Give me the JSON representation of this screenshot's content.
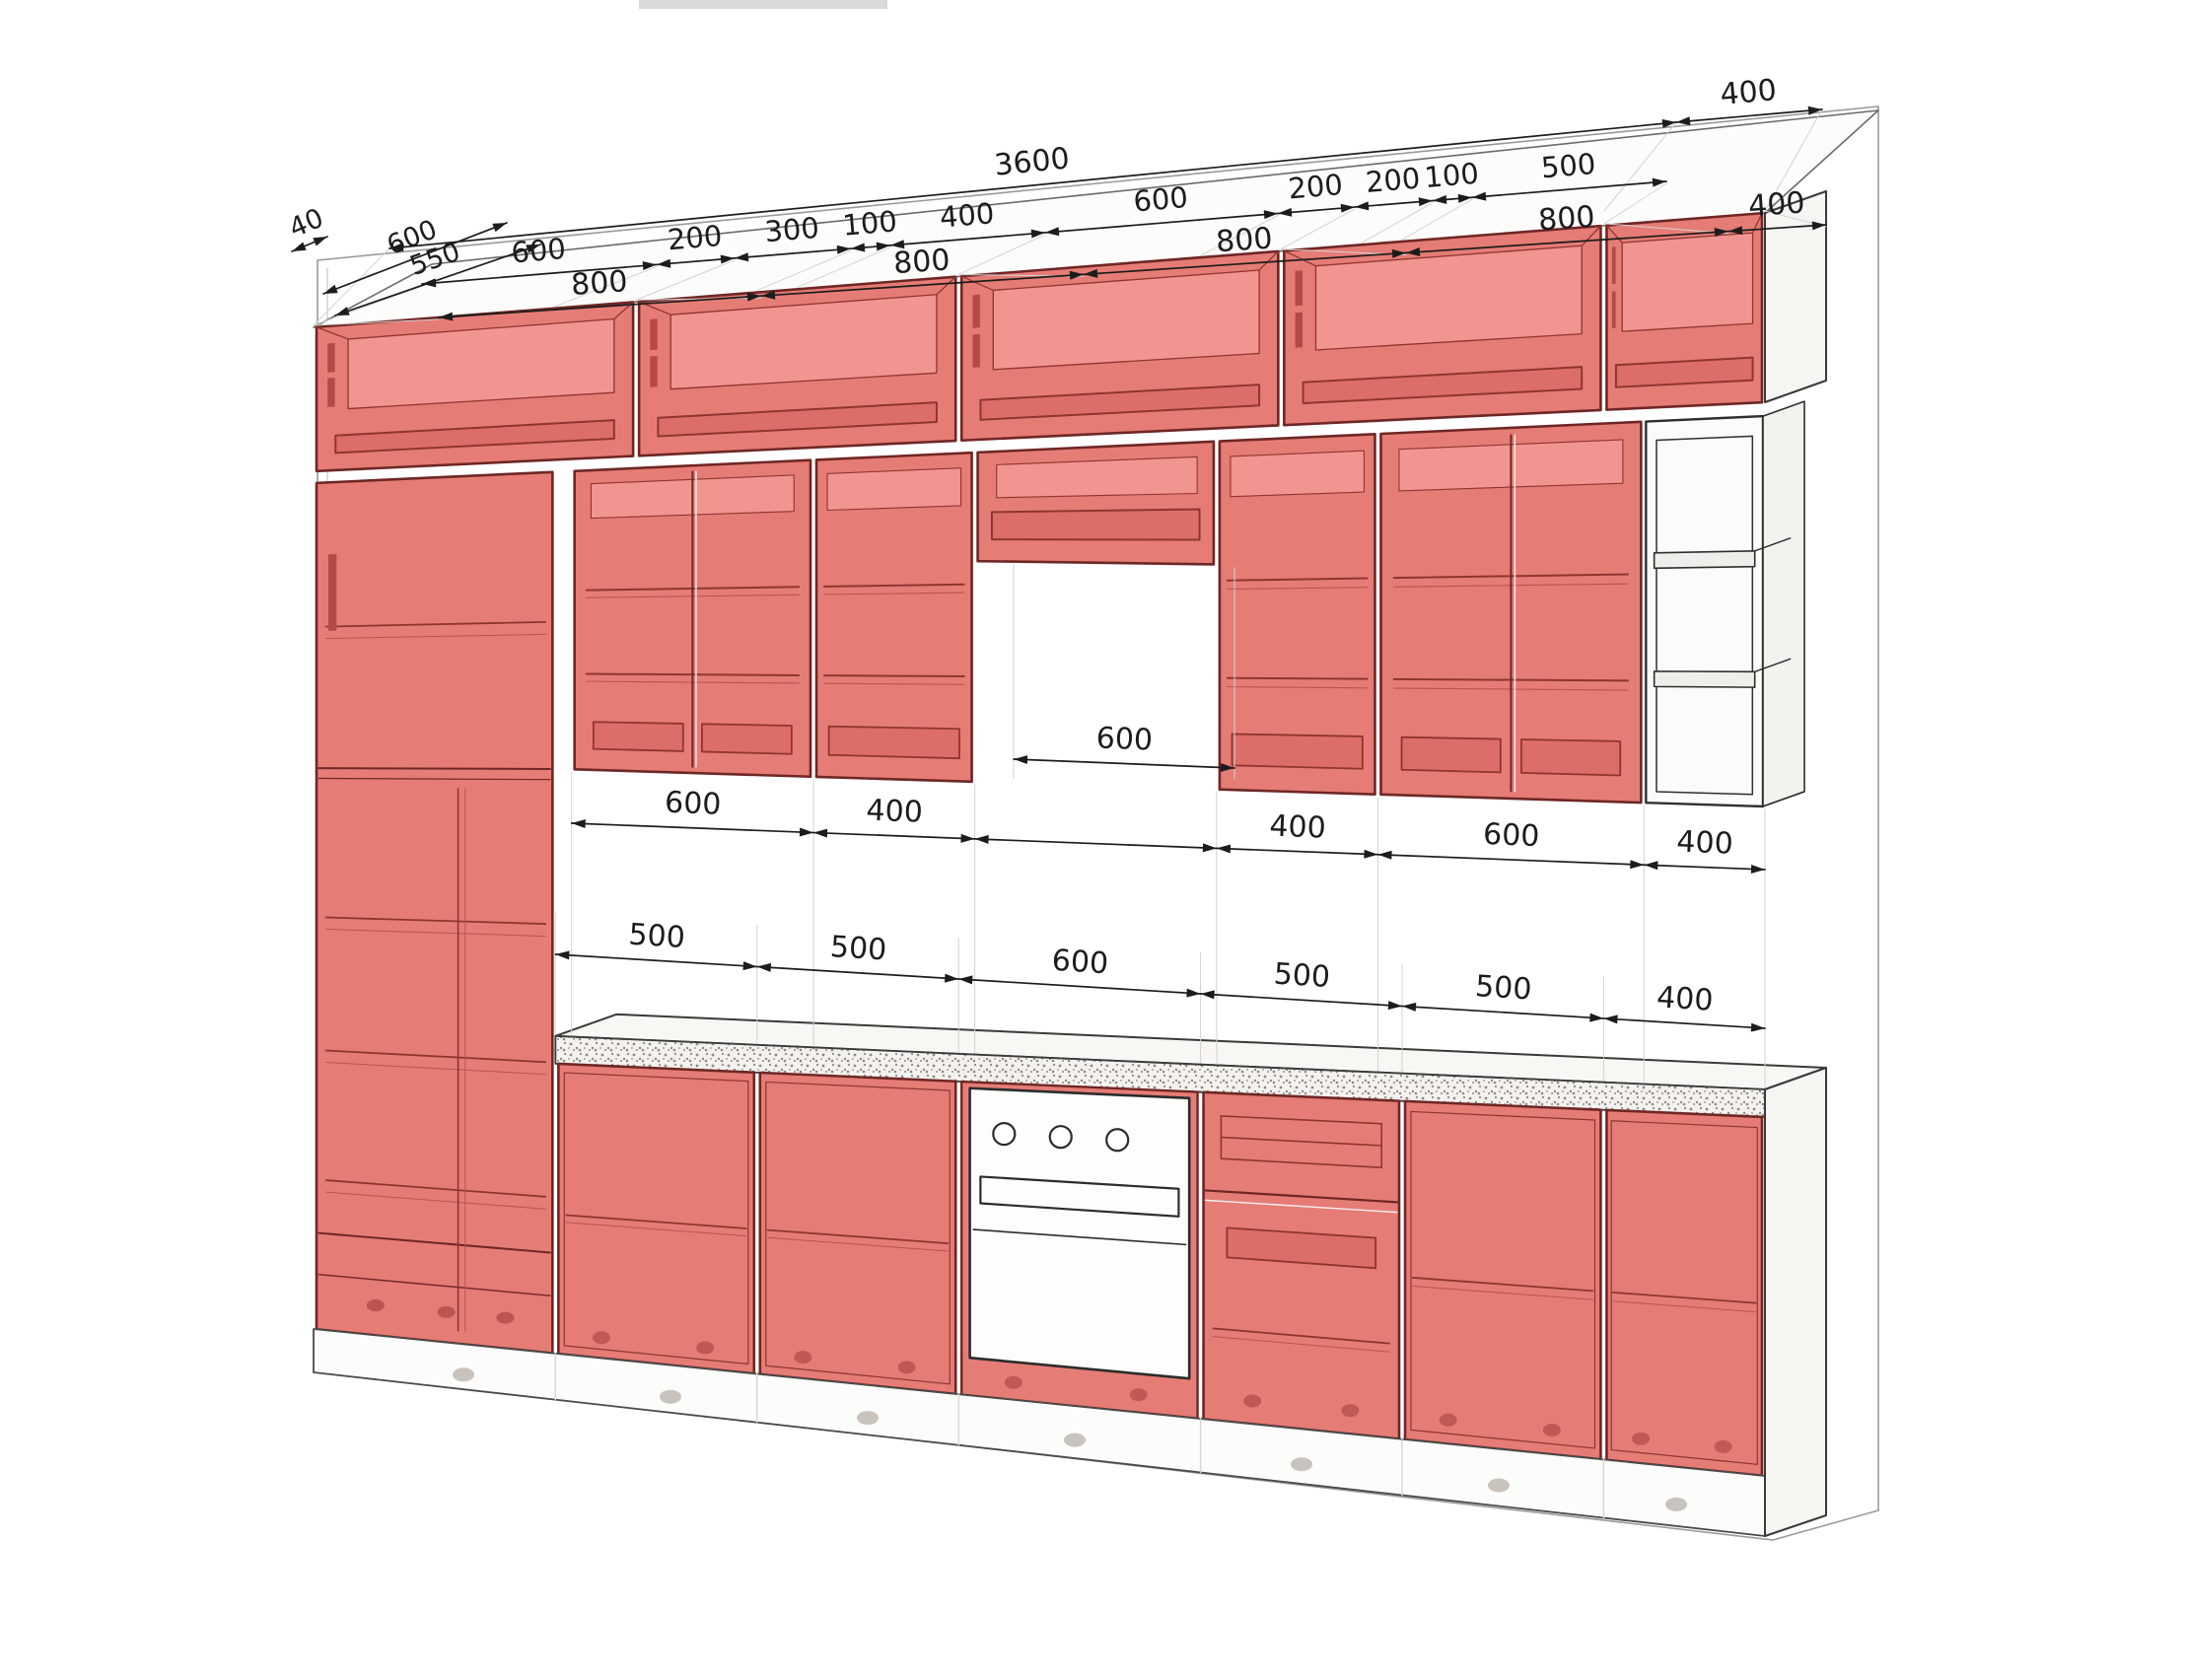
{
  "drawing": {
    "type": "kitchen-cabinet-elevation-3d",
    "units": "mm",
    "style": "translucent red fronts on white CAD background"
  },
  "colors": {
    "cabinet_front": "#e67c76",
    "cabinet_interior": "#f0958f",
    "cabinet_recess": "#dd6d68",
    "cabinet_edge": "#6e2725",
    "cabinet_detail": "#8f3531",
    "dimension_line": "#1c1c1c",
    "outline": "#3a3a3a",
    "white_face": "#fbfbfa",
    "background": "#ffffff"
  },
  "dims": {
    "overall_width": "3600",
    "right_depth": "400",
    "top_chain": [
      "600",
      "200",
      "300",
      "100",
      "400",
      "600",
      "200",
      "200",
      "100",
      "500"
    ],
    "unit_widths": [
      "800",
      "800",
      "800",
      "800",
      "400"
    ],
    "left_top_depth": "600",
    "left_gap": "40",
    "left_base_depth": "550",
    "hood_gap_width": "600",
    "wall_chain": [
      "600",
      "400",
      "400",
      "600",
      "400"
    ],
    "base_chain": [
      "500",
      "500",
      "600",
      "500",
      "500",
      "400"
    ]
  }
}
